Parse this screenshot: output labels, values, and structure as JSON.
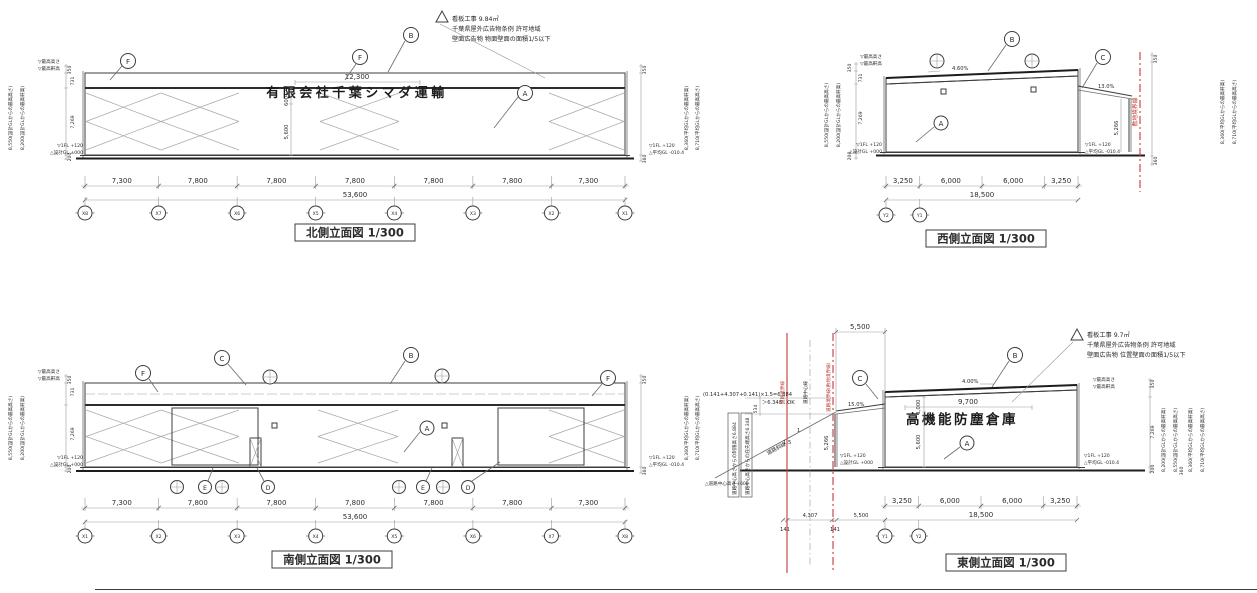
{
  "colors": {
    "red": "#c23b35",
    "ink": "#3a3a3a",
    "paper": "#ffffff"
  },
  "north": {
    "title": "北側立面図 1/300",
    "sign": {
      "text": "有限会社千葉シマダ運輸",
      "width_dim": "12,300",
      "height_dim": "600",
      "wall_dim": "5,600"
    },
    "note": {
      "l1": "看板工事 9.84㎡",
      "l2": "千葉県屋外広告物条例 許可地域",
      "l3": "壁面広告物 物面壁面の面積1/5以下"
    },
    "callouts": {
      "f1": "F",
      "f2": "F",
      "b": "B",
      "a": "A"
    },
    "dims": [
      "7,300",
      "7,800",
      "7,800",
      "7,800",
      "7,800",
      "7,800",
      "7,300"
    ],
    "dim_values": [
      7300,
      7800,
      7800,
      7800,
      7800,
      7800,
      7300
    ],
    "total": "53,600",
    "grids": [
      "X8",
      "X7",
      "X6",
      "X5",
      "X4",
      "X3",
      "X2",
      "X1"
    ],
    "left": {
      "h_max": "8,550(設計GLからの最高高さ)",
      "h_eave": "8,200(設計GLからの最高軒高)",
      "d_top": "350",
      "d_parapet": "731",
      "d_wall": "7,269",
      "d_base": "200",
      "mk_max": "▽最高高さ",
      "mk_eave": "▽最高軒高",
      "fl": "▽1FL +120",
      "gl": "△設計GL ±000"
    },
    "right": {
      "h_max": "8,710(平均GLからの最高高さ)",
      "h_eave": "8,360(平均GLからの最高軒高)",
      "d_top": "350",
      "d_base": "360",
      "fl": "▽1FL +120",
      "gl": "△平均GL -010.4"
    }
  },
  "west": {
    "title": "西側立面図 1/300",
    "roof_slope": "4.60%",
    "canopy_slope": "13.0%",
    "canopy_height": "5,266",
    "boundary_label": "敷地境界線",
    "callouts": {
      "b": "B",
      "c": "C",
      "a": "A"
    },
    "dims": [
      "3,250",
      "6,000",
      "6,000",
      "3,250"
    ],
    "dim_values": [
      3250,
      6000,
      6000,
      3250
    ],
    "total": "18,500",
    "grids": [
      "Y2",
      "Y1"
    ],
    "left": {
      "h_max": "8,550(設計GLからの最高高さ)",
      "h_eave": "8,200(設計GLからの最高軒高)",
      "d_top": "350",
      "d_parapet": "731",
      "d_wall": "7,269",
      "d_base": "200",
      "mk_max": "▽最高高さ",
      "mk_eave": "▽最高軒高",
      "fl": "▽1FL +120",
      "gl": "△設計GL +000"
    },
    "right": {
      "h_max": "8,710(平均GLからの最高高さ)",
      "h_eave": "8,360(平均GLからの最高軒高)",
      "d_top": "350",
      "d_base": "360",
      "fl": "▽1FL +120",
      "gl": "△平均GL -010.4"
    }
  },
  "south": {
    "title": "南側立面図 1/300",
    "callouts": {
      "f1": "F",
      "c": "C",
      "b": "B",
      "f2": "F",
      "a": "A",
      "e1": "E",
      "d1": "D",
      "e2": "E",
      "d2": "D"
    },
    "dims": [
      "7,300",
      "7,800",
      "7,800",
      "7,800",
      "7,800",
      "7,800",
      "7,300"
    ],
    "dim_values": [
      7300,
      7800,
      7800,
      7800,
      7800,
      7800,
      7300
    ],
    "total": "53,600",
    "grids": [
      "X1",
      "X2",
      "X3",
      "X4",
      "X5",
      "X6",
      "X7",
      "X8"
    ],
    "left": {
      "h_max": "8,550(設計GLからの最高高さ)",
      "h_eave": "8,200(設計GLからの最高軒高)",
      "d_top": "350",
      "d_parapet": "731",
      "d_wall": "7,269",
      "d_base": "200",
      "mk_max": "▽最高高さ",
      "mk_eave": "▽最高軒高",
      "fl": "▽1FL +120",
      "gl": "△設計GL +000"
    },
    "right": {
      "h_max": "8,710(平均GLからの最高高さ)",
      "h_eave": "8,360(平均GLからの最高軒高)",
      "d_top": "350",
      "d_base": "360",
      "fl": "▽1FL +120",
      "gl": "△平均GL -010.4"
    }
  },
  "east": {
    "title": "東側立面図 1/300",
    "sign": {
      "text": "高機能防塵倉庫",
      "width_dim": "9,700",
      "height_dim": "1,000",
      "wall_dim": "5,600"
    },
    "note": {
      "l1": "看板工事 9.7㎡",
      "l2": "千葉県屋外広告物条例 許可地域",
      "l3": "壁面広告物 位置壁面の面積1/5以下"
    },
    "roof_slope": "4.00%",
    "canopy_slope": "15.0%",
    "canopy_height": "5,266",
    "top_dim": "5,500",
    "callouts": {
      "b": "B",
      "c": "C",
      "a": "A"
    },
    "dims": [
      "3,250",
      "6,000",
      "6,000",
      "3,250"
    ],
    "dim_values": [
      3250,
      6000,
      6000,
      3250
    ],
    "total": "18,500",
    "grids": [
      "Y1",
      "Y2"
    ],
    "road": {
      "calc": "(0.141+4.307+0.141)×1.5=6.884",
      "ok": "＞6.348…OK",
      "limit_label": "道路中心高さからの制限高さ6.884",
      "tip_label": "道路中心高さからの庇先端高さ6.348",
      "slant_label": "道路斜線",
      "ratio_num": "1",
      "ratio_den": "1.5",
      "center_height": "△道路中心高さ+600",
      "d_534": "534",
      "d_141a": "141",
      "d_4307": "4,307",
      "d_141b": "141",
      "d_5500": "5,500",
      "line_left": "道路境界線",
      "line_center": "道路中心線",
      "line_right": "道路境界線(敷地境界線)"
    },
    "marks": {
      "mk_max": "▽最高高さ",
      "mk_eave": "▽最高軒高"
    },
    "gl_left": {
      "fl": "▽1FL +120",
      "gl": "△設計GL +000"
    },
    "gl_right": {
      "fl": "▽1FL +120",
      "gl": "△平均GL -010.4"
    },
    "right": {
      "h_eave_design": "8,200(設計GLからの最高軒高)",
      "h_max_design": "8,550(設計GLからの最高高さ)",
      "h_eave_avg": "8,360(平均GLからの最高軒高)",
      "h_max_avg": "8,710(平均GLからの最高高さ)",
      "d_top": "350",
      "d_wall": "7,269",
      "d_base": "200",
      "d_base2": "360"
    }
  }
}
